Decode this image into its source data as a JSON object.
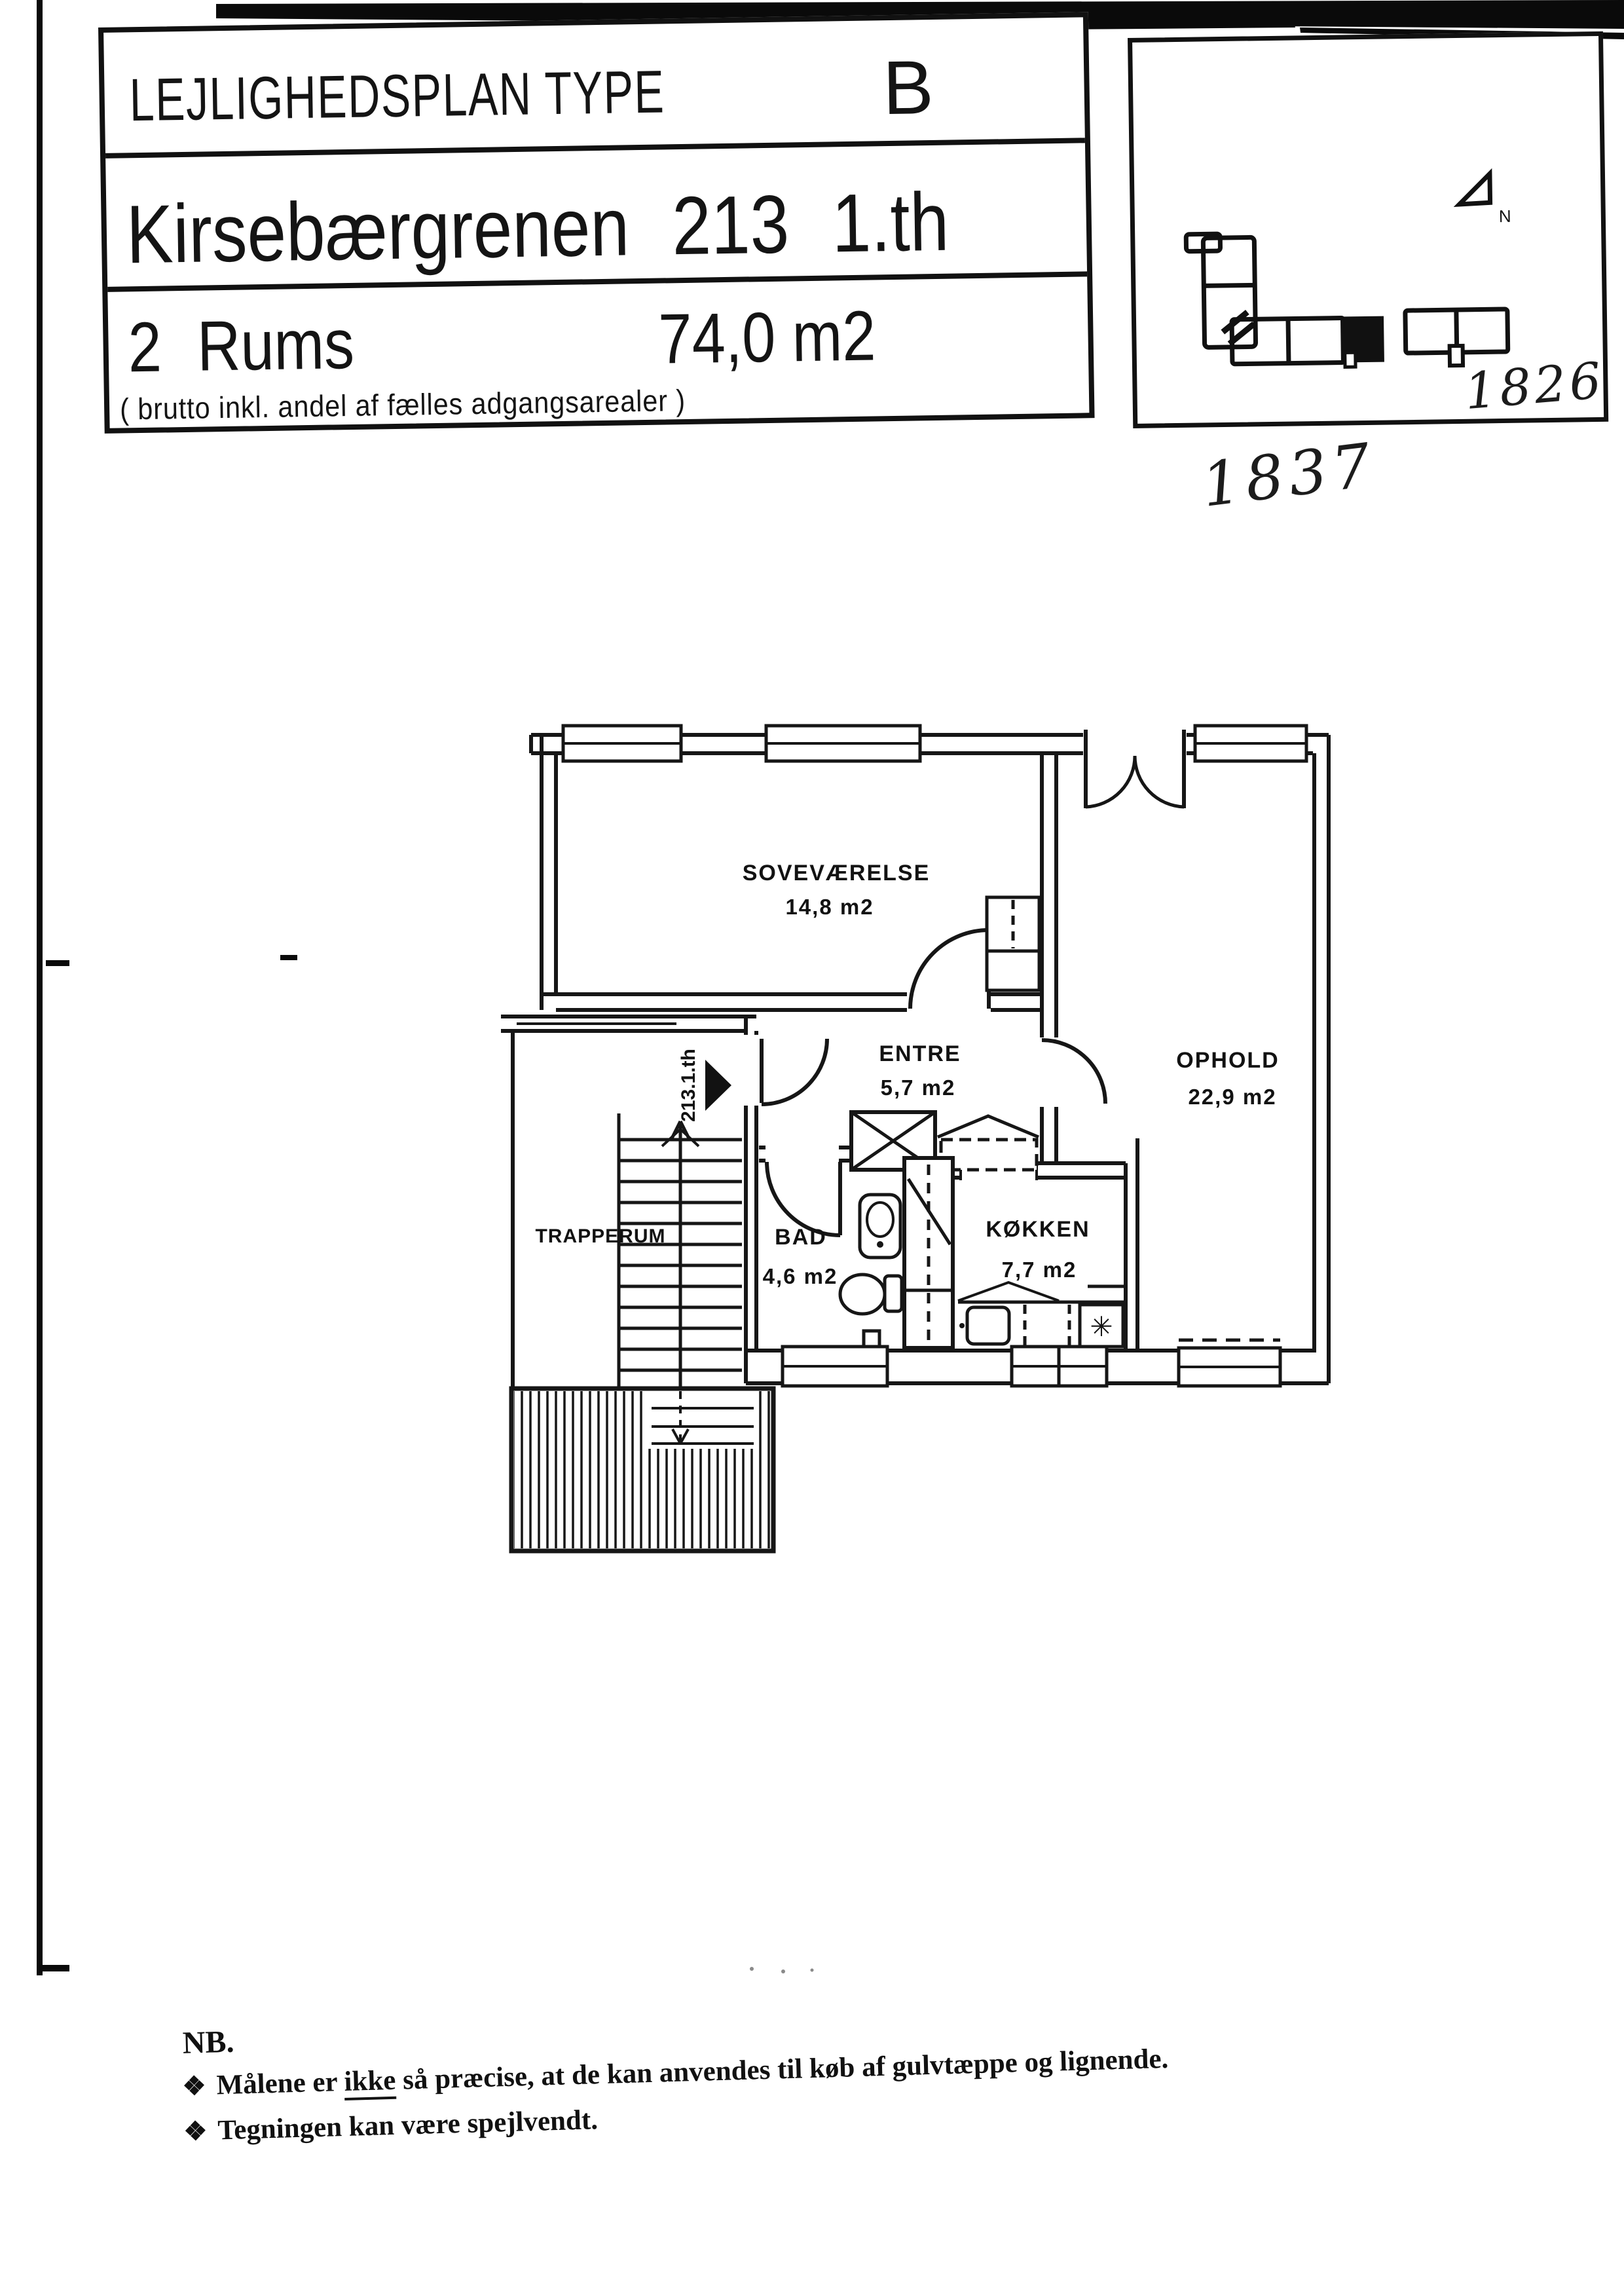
{
  "page": {
    "background": "#ffffff",
    "ink": "#141414"
  },
  "title_block": {
    "type_label": "LEJLIGHEDSPLAN TYPE",
    "type_value": "B",
    "address": "Kirsebærgrenen 213 1.th",
    "rooms": "2 Rums",
    "area": "74,0 m2",
    "area_note": "( brutto inkl. andel af fælles adgangsarealer )"
  },
  "site_box": {
    "north_label": "N",
    "handwritten_number": "1826",
    "handwritten_number_below": "1837"
  },
  "floor_plan": {
    "unit_label": "213.1.th",
    "stove_symbol": "✳",
    "rooms": [
      {
        "name": "SOVEVÆRELSE",
        "area": "14,8 m2"
      },
      {
        "name": "ENTRE",
        "area": "5,7 m2"
      },
      {
        "name": "OPHOLD",
        "area": "22,9 m2"
      },
      {
        "name": "BAD",
        "area": "4,6 m2"
      },
      {
        "name": "KØKKEN",
        "area": "7,7 m2"
      },
      {
        "name": "TRAPPERUM",
        "area": ""
      }
    ]
  },
  "notes": {
    "heading": "NB.",
    "bullet": "❖",
    "items": [
      {
        "prefix": "Målene er ",
        "underlined": "ikke",
        "suffix": " så præcise, at de kan anvendes til køb af gulvtæppe og lignende."
      },
      {
        "prefix": "",
        "underlined": "",
        "suffix": "Tegningen kan være spejlvendt."
      }
    ]
  }
}
